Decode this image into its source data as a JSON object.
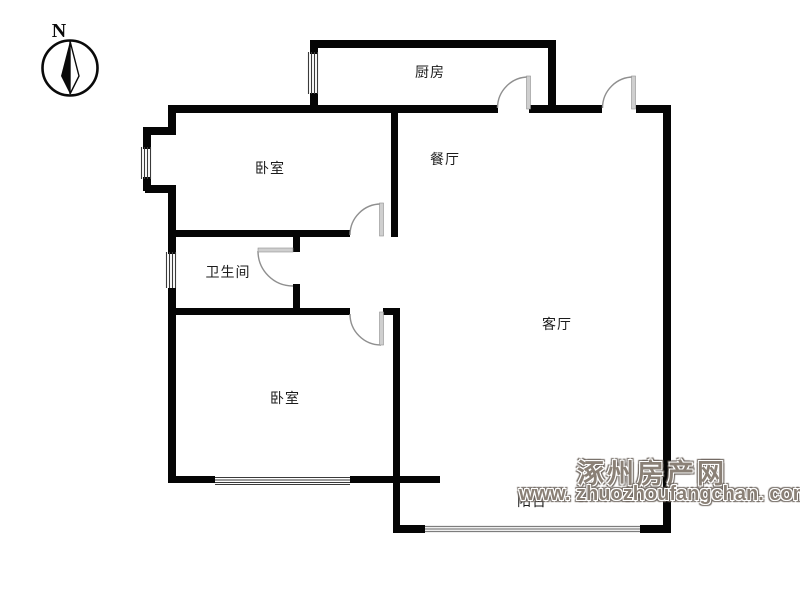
{
  "compass": {
    "label": "N",
    "icon": "compass-north-icon"
  },
  "rooms": {
    "kitchen": "厨房",
    "bedroom_top": "卧室",
    "dining": "餐厅",
    "bathroom": "卫生间",
    "living": "客厅",
    "bedroom_bottom": "卧室",
    "balcony": "阳台"
  },
  "watermark": {
    "site_name": "涿州房产网",
    "site_url": "www. zhuozhoufangchan. com"
  },
  "colors": {
    "wall": "#050505",
    "door": "#8f8f8f",
    "door_leaf": "#cfcfcf",
    "watermark": "#8a8076",
    "label": "#1c1c1c"
  }
}
